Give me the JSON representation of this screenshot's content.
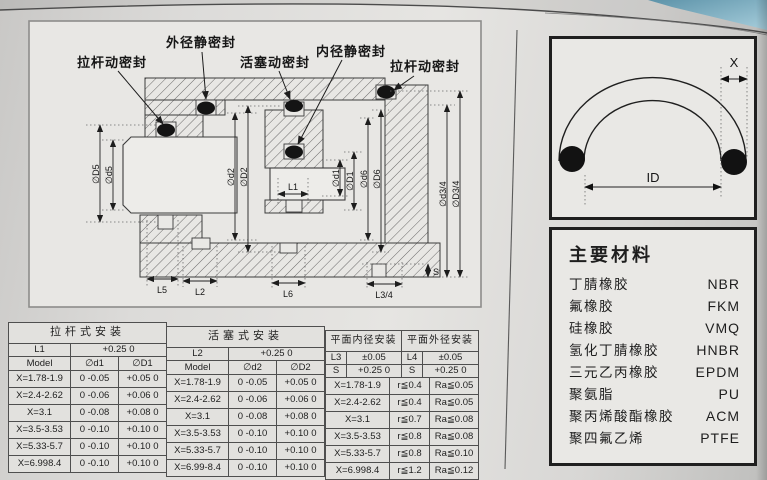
{
  "drawing": {
    "labels": {
      "rod_seal_left": "拉杆动密封",
      "od_static_seal": "外径静密封",
      "piston_seal": "活塞动密封",
      "id_static_seal": "内径静密封",
      "rod_seal_right": "拉杆动密封"
    },
    "dims": {
      "D5": "∅D5",
      "d5": "∅d5",
      "d2": "∅d2",
      "D2": "∅D2",
      "d1": "∅d1",
      "D1": "∅D1",
      "d6": "∅d6",
      "D6": "∅D6",
      "d34": "∅d3/4",
      "D34": "∅D3/4",
      "L1": "L1",
      "L5": "L5",
      "L2": "L2",
      "L6": "L6",
      "L34": "L3/4",
      "S": "S"
    }
  },
  "oring_figure": {
    "x_label": "X",
    "id_label": "ID"
  },
  "materials": {
    "title": "主要材料",
    "items": [
      {
        "name": "丁腈橡胶",
        "code": "NBR"
      },
      {
        "name": "氟橡胶",
        "code": "FKM"
      },
      {
        "name": "硅橡胶",
        "code": "VMQ"
      },
      {
        "name": "氢化丁腈橡胶",
        "code": "HNBR"
      },
      {
        "name": "三元乙丙橡胶",
        "code": "EPDM"
      },
      {
        "name": "聚氨脂",
        "code": "PU"
      },
      {
        "name": "聚丙烯酸酯橡胶",
        "code": "ACM"
      },
      {
        "name": "聚四氟乙烯",
        "code": "PTFE"
      }
    ]
  },
  "tables": {
    "rod": {
      "title": "拉杆式安装",
      "l_row": {
        "label": "L1",
        "tolerance": "+0.25 0"
      },
      "columns": [
        "Model",
        "∅d1",
        "∅D1"
      ],
      "rows": [
        [
          "X=1.78-1.9",
          "0 -0.05",
          "+0.05 0"
        ],
        [
          "X=2.4-2.62",
          "0 -0.06",
          "+0.06 0"
        ],
        [
          "X=3.1",
          "0 -0.08",
          "+0.08 0"
        ],
        [
          "X=3.5-3.53",
          "0 -0.10",
          "+0.10 0"
        ],
        [
          "X=5.33-5.7",
          "0 -0.10",
          "+0.10 0"
        ],
        [
          "X=6.998.4",
          "0 -0.10",
          "+0.10 0"
        ]
      ]
    },
    "piston": {
      "title": "活塞式安装",
      "l_row": {
        "label": "L2",
        "tolerance": "+0.25 0"
      },
      "columns": [
        "Model",
        "∅d2",
        "∅D2"
      ],
      "rows": [
        [
          "X=1.78-1.9",
          "0 -0.05",
          "+0.05 0"
        ],
        [
          "X=2.4-2.62",
          "0 -0.06",
          "+0.06 0"
        ],
        [
          "X=3.1",
          "0 -0.08",
          "+0.08 0"
        ],
        [
          "X=3.5-3.53",
          "0 -0.10",
          "+0.10 0"
        ],
        [
          "X=5.33-5.7",
          "0 -0.10",
          "+0.10 0"
        ],
        [
          "X=6.99-8.4",
          "0 -0.10",
          "+0.10 0"
        ]
      ]
    },
    "face": {
      "title_inner": "平面内径安装",
      "title_outer": "平面外径安装",
      "header_rows": [
        [
          "L3",
          "±0.05",
          "L4",
          "±0.05"
        ],
        [
          "S",
          "+0.25 0",
          "S",
          "+0.25 0"
        ]
      ],
      "rows": [
        [
          "X=1.78-1.9",
          "r≦0.4",
          "Ra≦0.05"
        ],
        [
          "X=2.4-2.62",
          "r≦0.4",
          "Ra≦0.05"
        ],
        [
          "X=3.1",
          "r≦0.7",
          "Ra≦0.08"
        ],
        [
          "X=3.5-3.53",
          "r≦0.8",
          "Ra≦0.08"
        ],
        [
          "X=5.33-5.7",
          "r≦0.8",
          "Ra≦0.10"
        ],
        [
          "X=6.998.4",
          "r≦1.2",
          "Ra≦0.12"
        ]
      ]
    }
  }
}
